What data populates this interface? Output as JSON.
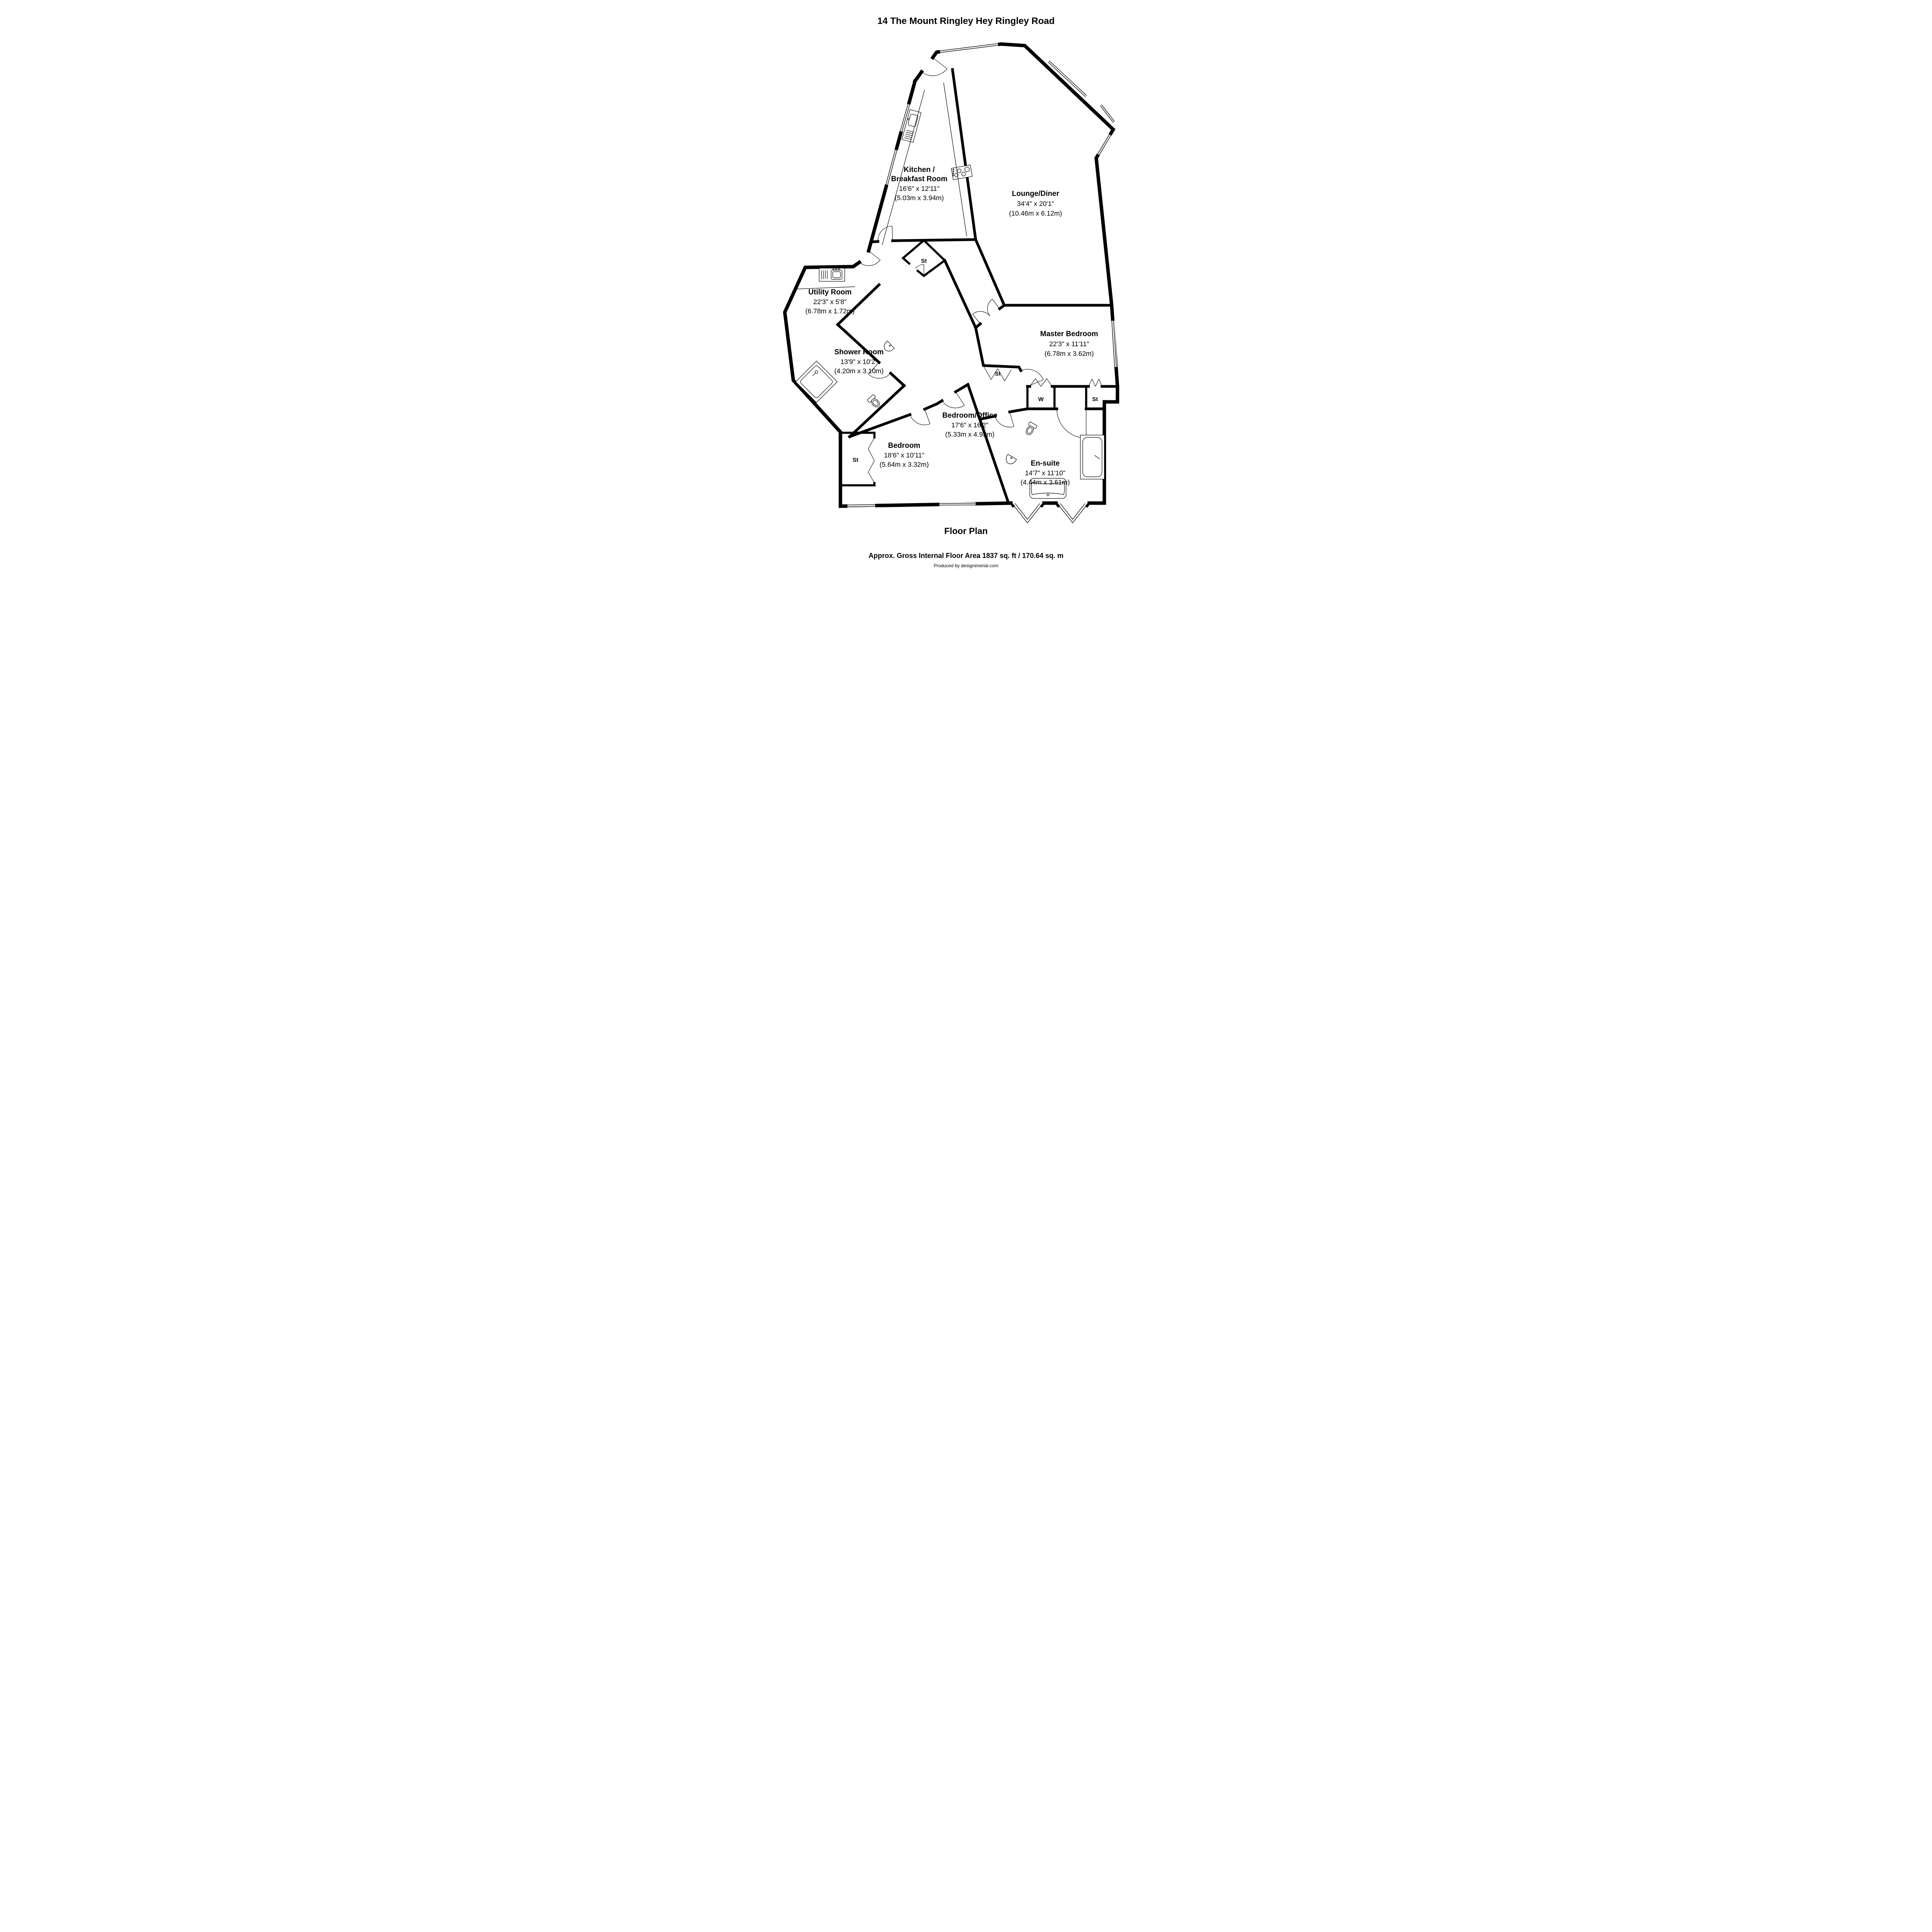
{
  "title": "14 The Mount Ringley Hey Ringley Road",
  "rooms": {
    "kitchen": {
      "name1": "Kitchen /",
      "name2": "Breakfast Room",
      "imperial": "16'6\" x 12'11\"",
      "metric": "(5.03m x 3.94m)"
    },
    "lounge": {
      "name1": "Lounge/Diner",
      "imperial": "34'4\" x 20'1\"",
      "metric": "(10.46m x 6.12m)"
    },
    "utility": {
      "name1": "Utility Room",
      "imperial": "22'3\" x 5'8\"",
      "metric": "(6.78m x 1.72m)"
    },
    "shower": {
      "name1": "Shower Room",
      "imperial": "13'9\" x 10'2\"",
      "metric": "(4.20m x 3.10m)"
    },
    "master": {
      "name1": "Master Bedroom",
      "imperial": "22'3\" x 11'11\"",
      "metric": "(6.78m x 3.62m)"
    },
    "bedroom_office": {
      "name1": "Bedroom/Office",
      "imperial": "17'6\" x 16'2\"",
      "metric": "(5.33m x 4.93m)"
    },
    "bedroom": {
      "name1": "Bedroom",
      "imperial": "18'6\" x 10'11\"",
      "metric": "(5.64m x 3.32m)"
    },
    "ensuite": {
      "name1": "En-suite",
      "imperial": "14'7\" x 11'10\"",
      "metric": "(4.44m x 3.61m)"
    }
  },
  "labels": {
    "st": "St",
    "w": "W"
  },
  "footer": {
    "heading": "Floor Plan",
    "area": "Approx. Gross Internal Floor Area 1837 sq. ft / 170.64 sq. m",
    "credit": "Produced by designimerial.com"
  },
  "colors": {
    "wall": "#000000",
    "background": "#ffffff"
  }
}
